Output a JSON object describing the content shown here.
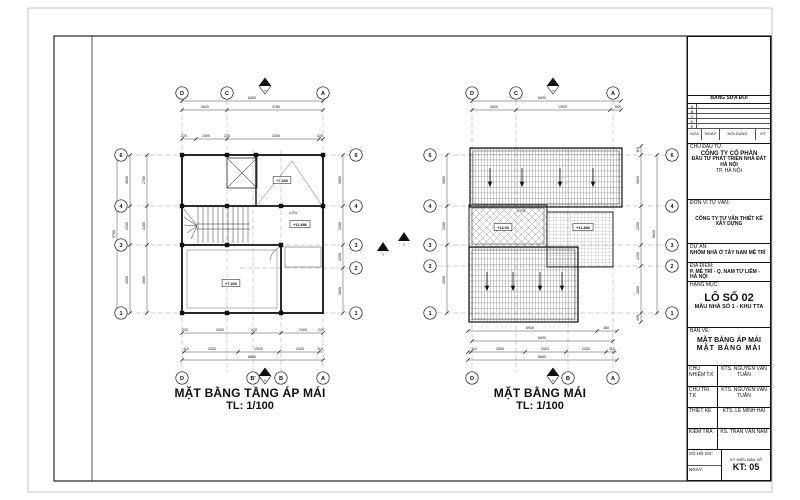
{
  "title_block": {
    "revision": {
      "header": "BẢNG SỬA ĐỔI",
      "rows": [
        "A",
        "B",
        "C",
        "D",
        "E"
      ],
      "columns": [
        "SỬA",
        "NGÀY",
        "NỘI DUNG",
        "KÝ"
      ]
    },
    "owner_label": "CHỦ ĐẦU TƯ:",
    "owner_line1": "CÔNG TY CỔ PHẦN",
    "owner_line2": "ĐẦU TƯ PHÁT TRIỂN NHÀ ĐẤT HÀ NỘI",
    "owner_line3": "TP. HÀ NỘI",
    "consultant_label": "ĐƠN VỊ TƯ VẤN:",
    "consultant_name": "CÔNG TY TƯ VẤN THIẾT KẾ XÂY DỰNG",
    "project_label": "DỰ ÁN:",
    "project_name": "NHÓM NHÀ Ở TÂY NAM MỄ TRÌ",
    "location_label": "ĐỊA ĐIỂM:",
    "location_name": "P. MỄ TRÌ - Q. NAM TỪ LIÊM - HÀ NỘI",
    "item_label": "HẠNG MỤC:",
    "item_name": "LÔ SỐ 02",
    "item_sub": "MẪU NHÀ SỐ 1 - KHU TTA",
    "drawing_label": "BẢN VẼ:",
    "drawing_title1": "MẶT BẰNG ÁP MÁI",
    "drawing_title2": "MẶT BẰNG MÁI",
    "signatures": [
      {
        "label": "CHỦ NHIỆM T.K",
        "name": "KTS. NGUYỄN VĂN TUẤN"
      },
      {
        "label": "CHỦ TRÌ T.K",
        "name": "KTS. NGUYỄN VĂN TUẤN"
      },
      {
        "label": "THIẾT KẾ",
        "name": "KTS. LÊ MINH HẢI"
      },
      {
        "label": "KIỂM TRA",
        "name": "KS. TRẦN VĂN NAM"
      }
    ],
    "file_label": "SỐ HỒ SƠ:",
    "date_label": "NGÀY:",
    "number_label": "KÝ HIỆU BẢN VẼ",
    "number": "KT: 05"
  },
  "plans": [
    {
      "title": "MẶT BẰNG TẦNG ÁP MÁI",
      "scale": "TL: 1/100",
      "bubbles": [
        {
          "label": "D",
          "x": 182,
          "y": 93
        },
        {
          "label": "C",
          "x": 227,
          "y": 93
        },
        {
          "label": "A",
          "x": 323,
          "y": 93
        },
        {
          "label": "6",
          "x": 121,
          "y": 155
        },
        {
          "label": "4",
          "x": 121,
          "y": 206
        },
        {
          "label": "3",
          "x": 121,
          "y": 245
        },
        {
          "label": "1",
          "x": 121,
          "y": 313
        },
        {
          "label": "6",
          "x": 356,
          "y": 155
        },
        {
          "label": "4",
          "x": 356,
          "y": 206
        },
        {
          "label": "3",
          "x": 356,
          "y": 245
        },
        {
          "label": "2",
          "x": 356,
          "y": 268
        },
        {
          "label": "1",
          "x": 356,
          "y": 313
        },
        {
          "label": "D",
          "x": 182,
          "y": 378
        },
        {
          "label": "B'",
          "x": 253,
          "y": 378
        },
        {
          "label": "B",
          "x": 281,
          "y": 378
        },
        {
          "label": "A",
          "x": 323,
          "y": 378
        }
      ],
      "dims": [
        {
          "text": "6400",
          "x": 252,
          "y": 99
        },
        {
          "text": "2620",
          "x": 205,
          "y": 108
        },
        {
          "text": "3780",
          "x": 276,
          "y": 108
        },
        {
          "text": "220",
          "x": 184,
          "y": 137
        },
        {
          "text": "2400",
          "x": 206,
          "y": 137
        },
        {
          "text": "220",
          "x": 227,
          "y": 137
        },
        {
          "text": "3340",
          "x": 276,
          "y": 137
        },
        {
          "text": "220",
          "x": 320,
          "y": 137
        },
        {
          "text": "220",
          "x": 185,
          "y": 331
        },
        {
          "text": "3400",
          "x": 220,
          "y": 331
        },
        {
          "text": "220",
          "x": 254,
          "y": 331
        },
        {
          "text": "2400",
          "x": 303,
          "y": 331
        },
        {
          "text": "220",
          "x": 321,
          "y": 331
        },
        {
          "text": "110",
          "x": 186,
          "y": 350
        },
        {
          "text": "3303",
          "x": 212,
          "y": 350
        },
        {
          "text": "2520",
          "x": 259,
          "y": 350
        },
        {
          "text": "2420",
          "x": 300,
          "y": 350
        },
        {
          "text": "110",
          "x": 320,
          "y": 350
        },
        {
          "text": "8660",
          "x": 252,
          "y": 358
        },
        {
          "text": "3600",
          "x": 128,
          "y": 180,
          "rot": 1
        },
        {
          "text": "2100",
          "x": 128,
          "y": 226,
          "rot": 1
        },
        {
          "text": "4000",
          "x": 128,
          "y": 280,
          "rot": 1
        },
        {
          "text": "2780",
          "x": 145,
          "y": 180,
          "rot": 1
        },
        {
          "text": "2160",
          "x": 145,
          "y": 226,
          "rot": 1
        },
        {
          "text": "3960",
          "x": 145,
          "y": 280,
          "rot": 1
        },
        {
          "text": "9700",
          "x": 115,
          "y": 234,
          "rot": 1
        },
        {
          "text": "3600",
          "x": 341,
          "y": 180,
          "rot": 1
        },
        {
          "text": "2100",
          "x": 341,
          "y": 226,
          "rot": 1
        },
        {
          "text": "1200",
          "x": 341,
          "y": 257,
          "rot": 1
        },
        {
          "text": "2800",
          "x": 341,
          "y": 291,
          "rot": 1
        }
      ],
      "levels": [
        {
          "text": "+7.400",
          "x": 282,
          "y": 181
        },
        {
          "text": "+11.886",
          "x": 300,
          "y": 225
        },
        {
          "text": "+7.400",
          "x": 231,
          "y": 284
        }
      ],
      "notes": [
        {
          "text": "i=2%",
          "x": 293,
          "y": 214
        }
      ],
      "chains": [
        {
          "o": "h",
          "c": 101,
          "f": 182,
          "t": 323,
          "ticks": [
            182,
            323
          ]
        },
        {
          "o": "h",
          "c": 110,
          "f": 182,
          "t": 323,
          "ticks": [
            182,
            227,
            323
          ]
        },
        {
          "o": "h",
          "c": 139,
          "f": 182,
          "t": 323,
          "ticks": [
            182,
            196,
            227,
            319,
            323
          ]
        },
        {
          "o": "h",
          "c": 333,
          "f": 182,
          "t": 323,
          "ticks": [
            182,
            253,
            281,
            323
          ]
        },
        {
          "o": "h",
          "c": 352,
          "f": 182,
          "t": 323,
          "ticks": [
            184,
            238,
            279,
            319
          ]
        },
        {
          "o": "h",
          "c": 360,
          "f": 182,
          "t": 323,
          "ticks": [
            182,
            323
          ]
        },
        {
          "o": "v",
          "c": 130,
          "f": 155,
          "t": 313,
          "ticks": [
            155,
            206,
            245,
            313
          ]
        },
        {
          "o": "v",
          "c": 147,
          "f": 155,
          "t": 313,
          "ticks": [
            155,
            206,
            245,
            313
          ]
        },
        {
          "o": "v",
          "c": 117,
          "f": 155,
          "t": 313,
          "ticks": [
            155,
            313
          ]
        },
        {
          "o": "v",
          "c": 343,
          "f": 155,
          "t": 313,
          "ticks": [
            155,
            206,
            245,
            268,
            313
          ]
        }
      ]
    },
    {
      "title": "MẶT BẰNG MÁI",
      "scale": "TL: 1/100",
      "bubbles": [
        {
          "label": "D",
          "x": 472,
          "y": 93
        },
        {
          "label": "C",
          "x": 516,
          "y": 93
        },
        {
          "label": "A",
          "x": 613,
          "y": 93
        },
        {
          "label": "6",
          "x": 430,
          "y": 155
        },
        {
          "label": "4",
          "x": 430,
          "y": 206
        },
        {
          "label": "3",
          "x": 430,
          "y": 245
        },
        {
          "label": "2",
          "x": 430,
          "y": 266
        },
        {
          "label": "1",
          "x": 430,
          "y": 313
        },
        {
          "label": "6",
          "x": 672,
          "y": 155
        },
        {
          "label": "4",
          "x": 672,
          "y": 206
        },
        {
          "label": "3",
          "x": 672,
          "y": 245
        },
        {
          "label": "2",
          "x": 672,
          "y": 266
        },
        {
          "label": "1",
          "x": 672,
          "y": 313
        },
        {
          "label": "D",
          "x": 472,
          "y": 378
        },
        {
          "label": "B",
          "x": 568,
          "y": 378
        },
        {
          "label": "A",
          "x": 613,
          "y": 378
        }
      ],
      "dims": [
        {
          "text": "6400",
          "x": 542,
          "y": 99
        },
        {
          "text": "2620",
          "x": 494,
          "y": 108
        },
        {
          "text": "2920",
          "x": 563,
          "y": 108
        },
        {
          "text": "540",
          "x": 618,
          "y": 108
        },
        {
          "text": "5930",
          "x": 530,
          "y": 329
        },
        {
          "text": "380",
          "x": 606,
          "y": 329
        },
        {
          "text": "6400",
          "x": 542,
          "y": 339
        },
        {
          "text": "110",
          "x": 474,
          "y": 350
        },
        {
          "text": "3300",
          "x": 500,
          "y": 350
        },
        {
          "text": "2520",
          "x": 545,
          "y": 350
        },
        {
          "text": "2420",
          "x": 586,
          "y": 350
        },
        {
          "text": "110",
          "x": 612,
          "y": 350
        },
        {
          "text": "8660",
          "x": 542,
          "y": 358
        },
        {
          "text": "3600",
          "x": 445,
          "y": 180,
          "rot": 1
        },
        {
          "text": "2100",
          "x": 445,
          "y": 226,
          "rot": 1
        },
        {
          "text": "4000",
          "x": 445,
          "y": 280,
          "rot": 1
        },
        {
          "text": "110",
          "x": 639,
          "y": 150,
          "rot": 1
        },
        {
          "text": "3600",
          "x": 639,
          "y": 180,
          "rot": 1
        },
        {
          "text": "2100",
          "x": 639,
          "y": 226,
          "rot": 1
        },
        {
          "text": "1200",
          "x": 639,
          "y": 256,
          "rot": 1
        },
        {
          "text": "2800",
          "x": 639,
          "y": 290,
          "rot": 1
        },
        {
          "text": "400",
          "x": 639,
          "y": 318,
          "rot": 1
        },
        {
          "text": "9640",
          "x": 655,
          "y": 234,
          "rot": 1
        }
      ],
      "levels": [
        {
          "text": "+14.00",
          "x": 503,
          "y": 228
        },
        {
          "text": "+11.886",
          "x": 583,
          "y": 228
        }
      ],
      "notes": [
        {
          "text": "i=2%",
          "x": 521,
          "y": 212
        }
      ],
      "chains": [
        {
          "o": "h",
          "c": 101,
          "f": 472,
          "t": 621,
          "ticks": [
            472,
            621
          ]
        },
        {
          "o": "h",
          "c": 110,
          "f": 472,
          "t": 621,
          "ticks": [
            472,
            516,
            610,
            621
          ]
        },
        {
          "o": "h",
          "c": 331,
          "f": 468,
          "t": 617,
          "ticks": [
            468,
            597,
            617
          ]
        },
        {
          "o": "h",
          "c": 341,
          "f": 472,
          "t": 613,
          "ticks": [
            472,
            613
          ]
        },
        {
          "o": "h",
          "c": 352,
          "f": 468,
          "t": 617,
          "ticks": [
            468,
            471,
            525,
            566,
            606,
            614
          ]
        },
        {
          "o": "h",
          "c": 360,
          "f": 468,
          "t": 617,
          "ticks": [
            468,
            617
          ]
        },
        {
          "o": "v",
          "c": 447,
          "f": 155,
          "t": 313,
          "ticks": [
            155,
            206,
            245,
            313
          ]
        },
        {
          "o": "v",
          "c": 641,
          "f": 146,
          "t": 322,
          "ticks": [
            146,
            155,
            206,
            245,
            266,
            313,
            322
          ]
        },
        {
          "o": "v",
          "c": 657,
          "f": 155,
          "t": 313,
          "ticks": [
            155,
            313
          ]
        }
      ]
    }
  ],
  "markers": [
    {
      "type": "north",
      "x": 265,
      "y": 86,
      "label": "A"
    },
    {
      "type": "north",
      "x": 553,
      "y": 86,
      "label": "A"
    },
    {
      "type": "north",
      "x": 265,
      "y": 376,
      "label": "A"
    },
    {
      "type": "north",
      "x": 553,
      "y": 376,
      "label": "A"
    },
    {
      "type": "cut",
      "x": 383,
      "y": 247,
      "label": "3"
    },
    {
      "type": "cut",
      "x": 404,
      "y": 237,
      "label": "3"
    }
  ]
}
